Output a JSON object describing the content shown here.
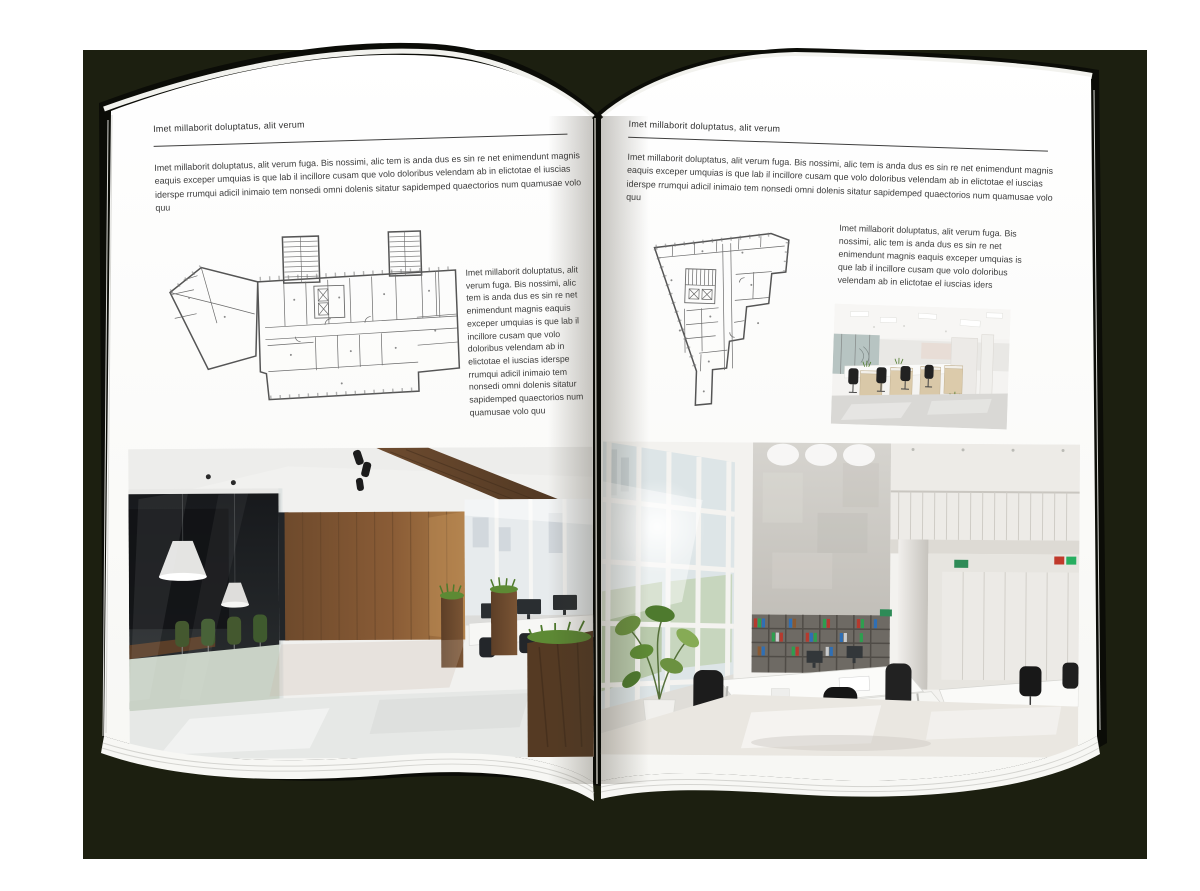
{
  "scene": {
    "backdrop_color": "#1c1f10",
    "page_color": "#fcfcfa",
    "text_color": "#3d3d3d",
    "rule_color": "#3f3f3f",
    "plan_line_color": "#6a6a6a",
    "wood_accent": "#7a5433",
    "plant_green": "#4e7a2c"
  },
  "left_page": {
    "header": "Imet millaborit doluptatus, alit verum",
    "intro": "Imet millaborit doluptatus, alit verum fuga. Bis nossimi, alic tem is anda dus es sin re net enimendunt magnis eaquis exceper umquias is que lab il incillore cusam que volo doloribus velendam ab in elictotae el iuscias iderspe rrumqui adicil inimaio tem nonsedi omni dolenis sitatur sapidemped quaectorios num quamusae volo quu",
    "sidebar_text": "Imet millaborit doluptatus, alit verum fuga. Bis nossimi, alic tem is anda dus es sin re net enimendunt magnis eaquis exceper umquias is que lab il incillore cusam que volo doloribus velendam ab in elictotae el iuscias iderspe rrumqui adicil inimaio tem nonsedi omni dolenis sitatur sapidemped quaectorios num quamusae volo quu"
  },
  "right_page": {
    "header": "Imet millaborit doluptatus, alit verum",
    "intro": "Imet millaborit doluptatus, alit verum fuga. Bis nossimi, alic tem is anda dus es sin re net enimendunt magnis eaquis exceper umquias is que lab il incillore cusam que volo doloribus velendam ab in elictotae el iuscias iderspe rrumqui adicil inimaio tem nonsedi omni dolenis sitatur sapidemped quaectorios num quamusae volo quu",
    "body_text": "Imet millaborit doluptatus, alit verum fuga. Bis nossimi, alic tem is anda dus es sin re net enimendunt magnis eaquis exceper umquias is que lab il incillore cusam que volo doloribus velendam ab in elictotae el iuscias iders"
  }
}
